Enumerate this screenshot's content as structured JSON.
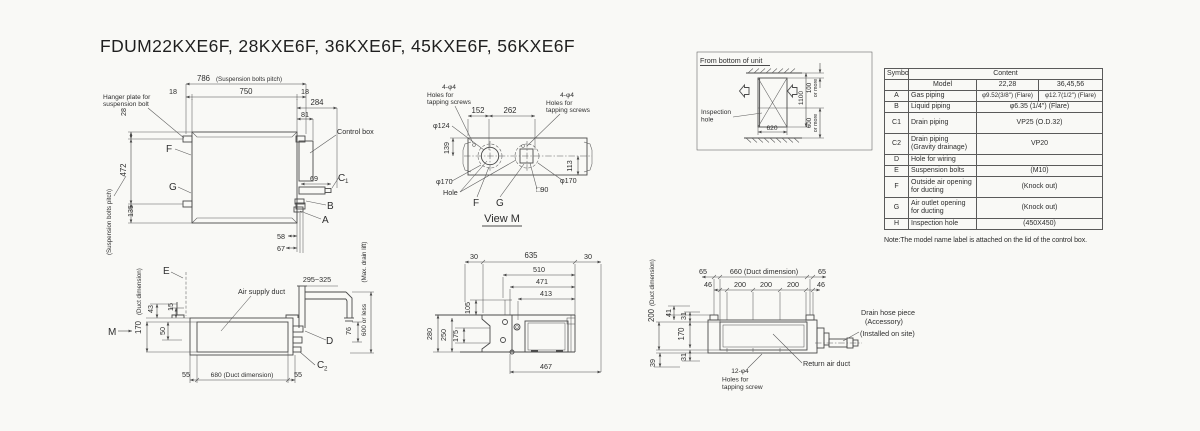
{
  "title": "FDUM22KXE6F, 28KXE6F, 36KXE6F, 45KXE6F, 56KXE6F",
  "plan": {
    "d786": "786",
    "pitch_note": "(Suspension bolts pitch)",
    "d18l": "18",
    "d750": "750",
    "d18r": "18",
    "d284": "284",
    "d81": "81",
    "hanger1": "Hanger plate for",
    "hanger2": "suspension bolt",
    "control_box": "Control box",
    "d28": "28",
    "d472": "472",
    "d135": "135",
    "pitch_side": "(Suspension bolts pitch)",
    "f": "F",
    "g": "G",
    "d69": "69",
    "c1": "C",
    "c1sub": "1",
    "b": "B",
    "a": "A",
    "d58": "58",
    "d67": "67"
  },
  "viewm": {
    "tap1": "4-φ4",
    "tap2": "Holes for",
    "tap3": "tapping screws",
    "d152": "152",
    "d262": "262",
    "dia124": "φ124",
    "d139": "139",
    "dia170l": "φ170",
    "hole": "Hole",
    "f": "F",
    "g": "G",
    "sq90": "□90",
    "dia170r": "φ170",
    "d113": "113",
    "caption": "View M"
  },
  "inset": {
    "title": "From bottom of unit",
    "insp1": "Inspection",
    "insp2": "hole",
    "d620": "620",
    "d1100": "1100",
    "d100": "100",
    "more1": "or more",
    "d600": "600",
    "more2": "or more"
  },
  "table": {
    "symbol": "Symbol",
    "content": "Content",
    "model": "Model",
    "m2228": "22,28",
    "m364556": "36,45,56",
    "rows": [
      {
        "sym": "A",
        "label": "Gas piping",
        "v1": "φ9.52(3/8\") (Flare)",
        "v2": "φ12.7(1/2\") (Flare)"
      },
      {
        "sym": "B",
        "label": "Liquid piping",
        "v": "φ6.35 (1/4\") (Flare)"
      },
      {
        "sym": "C1",
        "label": "Drain piping",
        "v": "VP25 (O.D.32)"
      },
      {
        "sym": "C2",
        "label": "Drain piping\n(Gravity drainage)",
        "v": "VP20"
      },
      {
        "sym": "D",
        "label": "Hole for wiring",
        "v": ""
      },
      {
        "sym": "E",
        "label": "Suspension bolts",
        "v": "(M10)"
      },
      {
        "sym": "F",
        "label": "Outside air opening\nfor ducting",
        "v": "(Knock out)"
      },
      {
        "sym": "G",
        "label": "Air outlet opening\nfor ducting",
        "v": "(Knock out)"
      },
      {
        "sym": "H",
        "label": "Inspection hole",
        "v": "(450X450)"
      }
    ],
    "note": "Note:The model name label is attached on the lid of the control box."
  },
  "side": {
    "e": "E",
    "air": "Air supply duct",
    "d170": "170",
    "duct_note": "(Duct dimension)",
    "d43": "43",
    "d15": "15",
    "d50": "50",
    "m": "M",
    "d55l": "55",
    "d680": "680 (Duct dimension)",
    "d55r": "55",
    "d295": "295~325",
    "d76": "76",
    "d600": "600 or less",
    "maxdrain": "(Max. drain lift)",
    "d": "D",
    "c2": "C",
    "c2sub": "2"
  },
  "endv": {
    "d30l": "30",
    "d635": "635",
    "d30r": "30",
    "d510": "510",
    "d471": "471",
    "d413": "413",
    "d105": "105",
    "d175": "175",
    "d250": "250",
    "d280": "280",
    "d467": "467"
  },
  "ret": {
    "d65l": "65",
    "d660": "660 (Duct dimension)",
    "d65r": "65",
    "d46l": "46",
    "d200a": "200",
    "d200b": "200",
    "d200c": "200",
    "d46r": "46",
    "d200v": "200",
    "duct_note": "(Duct dimension)",
    "d41": "41",
    "d31a": "31",
    "d170": "170",
    "d31b": "31",
    "d39": "39",
    "holes1": "12-φ4",
    "holes2": "Holes for",
    "holes3": "tapping screw",
    "return_duct": "Return air duct",
    "drain1": "Drain hose piece",
    "drain2": "(Accessory)",
    "drain3": "(Installed on site)"
  }
}
